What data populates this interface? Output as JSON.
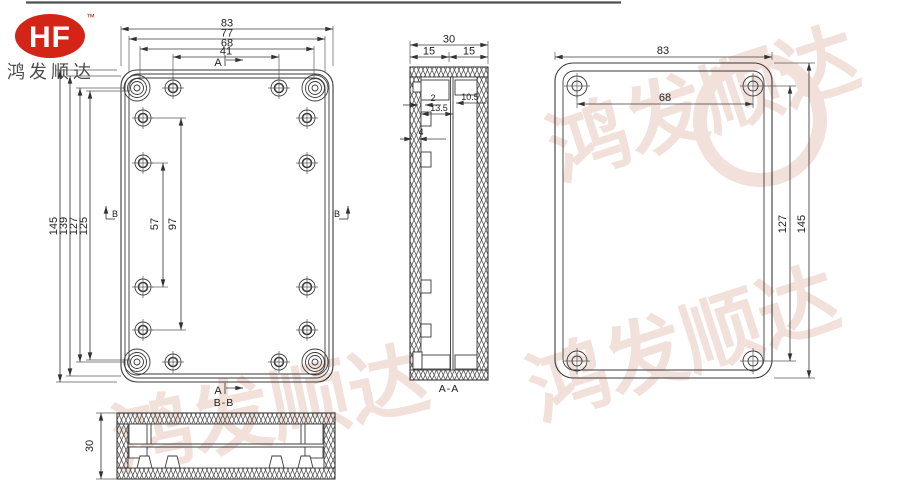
{
  "brand": {
    "logo_text": "HF",
    "trademark": "™",
    "company_name": "鸿发顺达"
  },
  "watermark": {
    "text": "鸿发顺达"
  },
  "front_view": {
    "width_total": "83",
    "width_shell": "77",
    "width_hole_cols": "68",
    "width_top_holes": "41",
    "height_total": "145",
    "height_shell": "139",
    "height_corner_holes": "127",
    "height_side_cols": "125",
    "side_span_inner": "57",
    "side_span_outer": "97",
    "section_marker_a": "A",
    "section_marker_b": "B"
  },
  "section_aa": {
    "title": "A-A",
    "depth_total": "30",
    "depth_front": "15",
    "depth_back": "15",
    "wall_thickness": "2",
    "lid_depth": "13.5",
    "pocket_depth": "10.5",
    "rib_width": "4"
  },
  "back_view": {
    "width_total": "83",
    "hole_span_width": "68",
    "hole_span_height": "127",
    "height_total": "145"
  },
  "section_bb": {
    "title": "B-B",
    "height_total": "30"
  },
  "colors": {
    "brand_red": "#d42417",
    "line": "#3a3a3a",
    "watermark": "#f2e0da"
  }
}
